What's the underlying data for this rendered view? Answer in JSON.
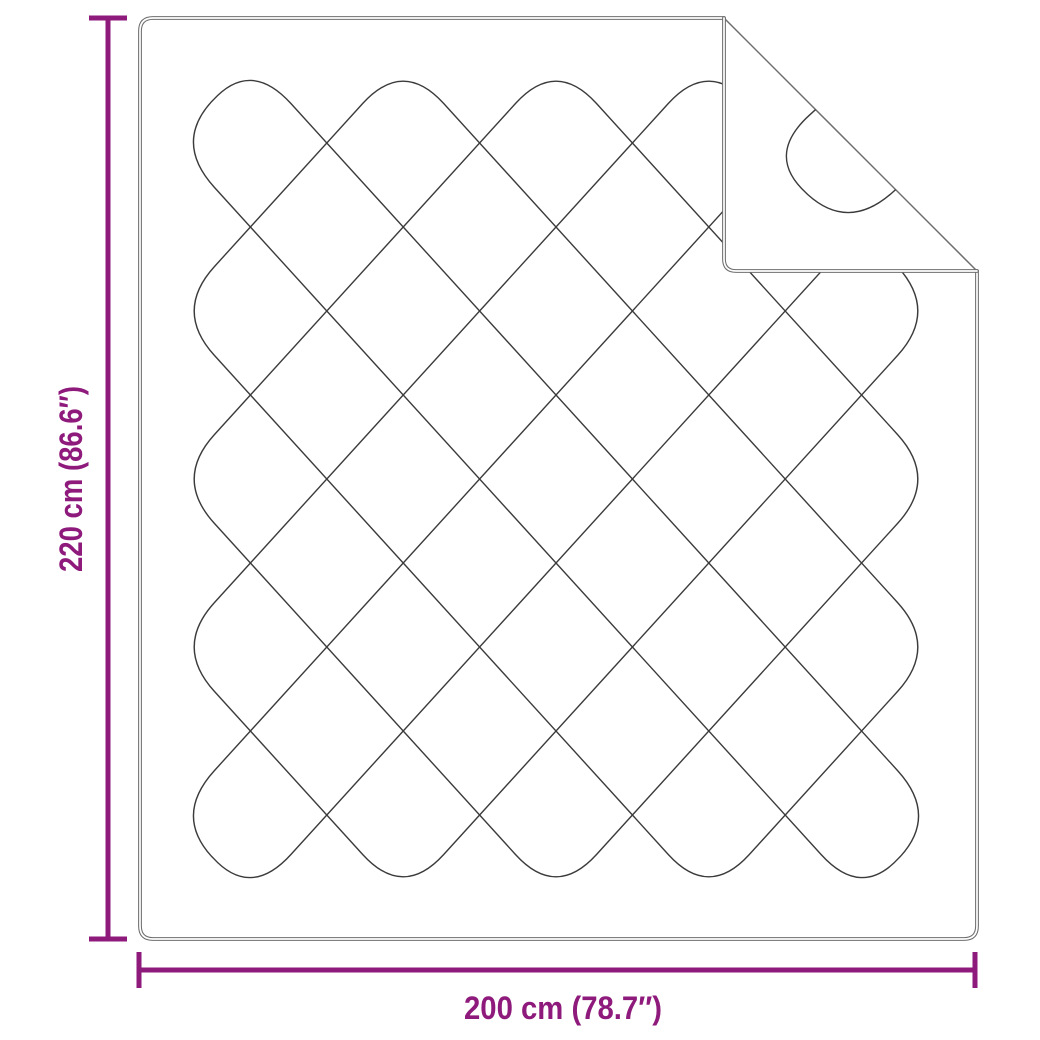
{
  "diagram": {
    "dimensions": {
      "height": {
        "label": "220 cm (86.6″)"
      },
      "width": {
        "label": "200 cm (78.7″)"
      }
    },
    "colors": {
      "dimension_accent": "#8e1a7c",
      "blanket_outline": "#6e6e6e",
      "stitching": "#3b3b3b",
      "background": "#ffffff"
    }
  }
}
